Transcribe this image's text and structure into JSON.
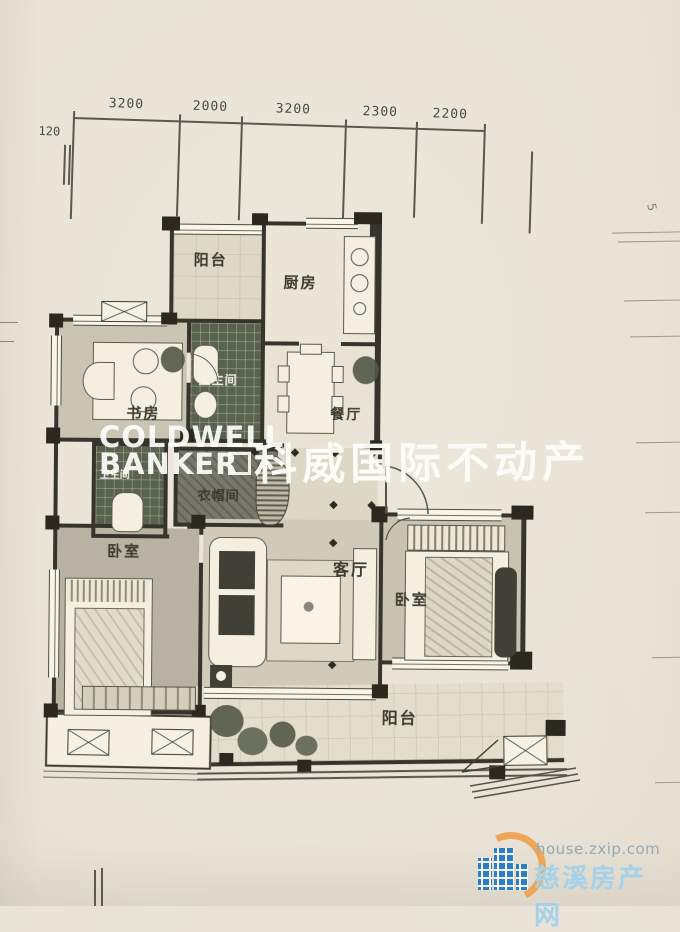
{
  "dimensions": {
    "side_offset": "120",
    "top": [
      "3200",
      "2000",
      "3200",
      "2300",
      "2200"
    ],
    "right_partial": "5"
  },
  "rooms": {
    "balcony_top": "阳台",
    "kitchen": "厨房",
    "bathroom_main": "卫生间",
    "study": "书房",
    "dining": "餐厅",
    "cloakroom": "衣帽间",
    "bathroom_second": "卫生间",
    "bedroom_left": "卧室",
    "living": "客厅",
    "bedroom_right": "卧室",
    "balcony_bottom": "阳台"
  },
  "watermark": {
    "line1": "COLDWELL",
    "line2": "BANKER",
    "cjk": "科威国际不动产"
  },
  "site_logo": {
    "url": "house.zxip.com",
    "name": "慈溪房产网"
  },
  "colors": {
    "paper": "#e8e3d6",
    "wall": "#35342d",
    "dark_tile": "#57604f",
    "watermark": "#fdfdfa",
    "logo_blue": "#2e7fc2",
    "logo_orange": "#f0a352",
    "logo_name_blue": "#a5d2ea",
    "logo_url_gray": "#93aab8"
  }
}
